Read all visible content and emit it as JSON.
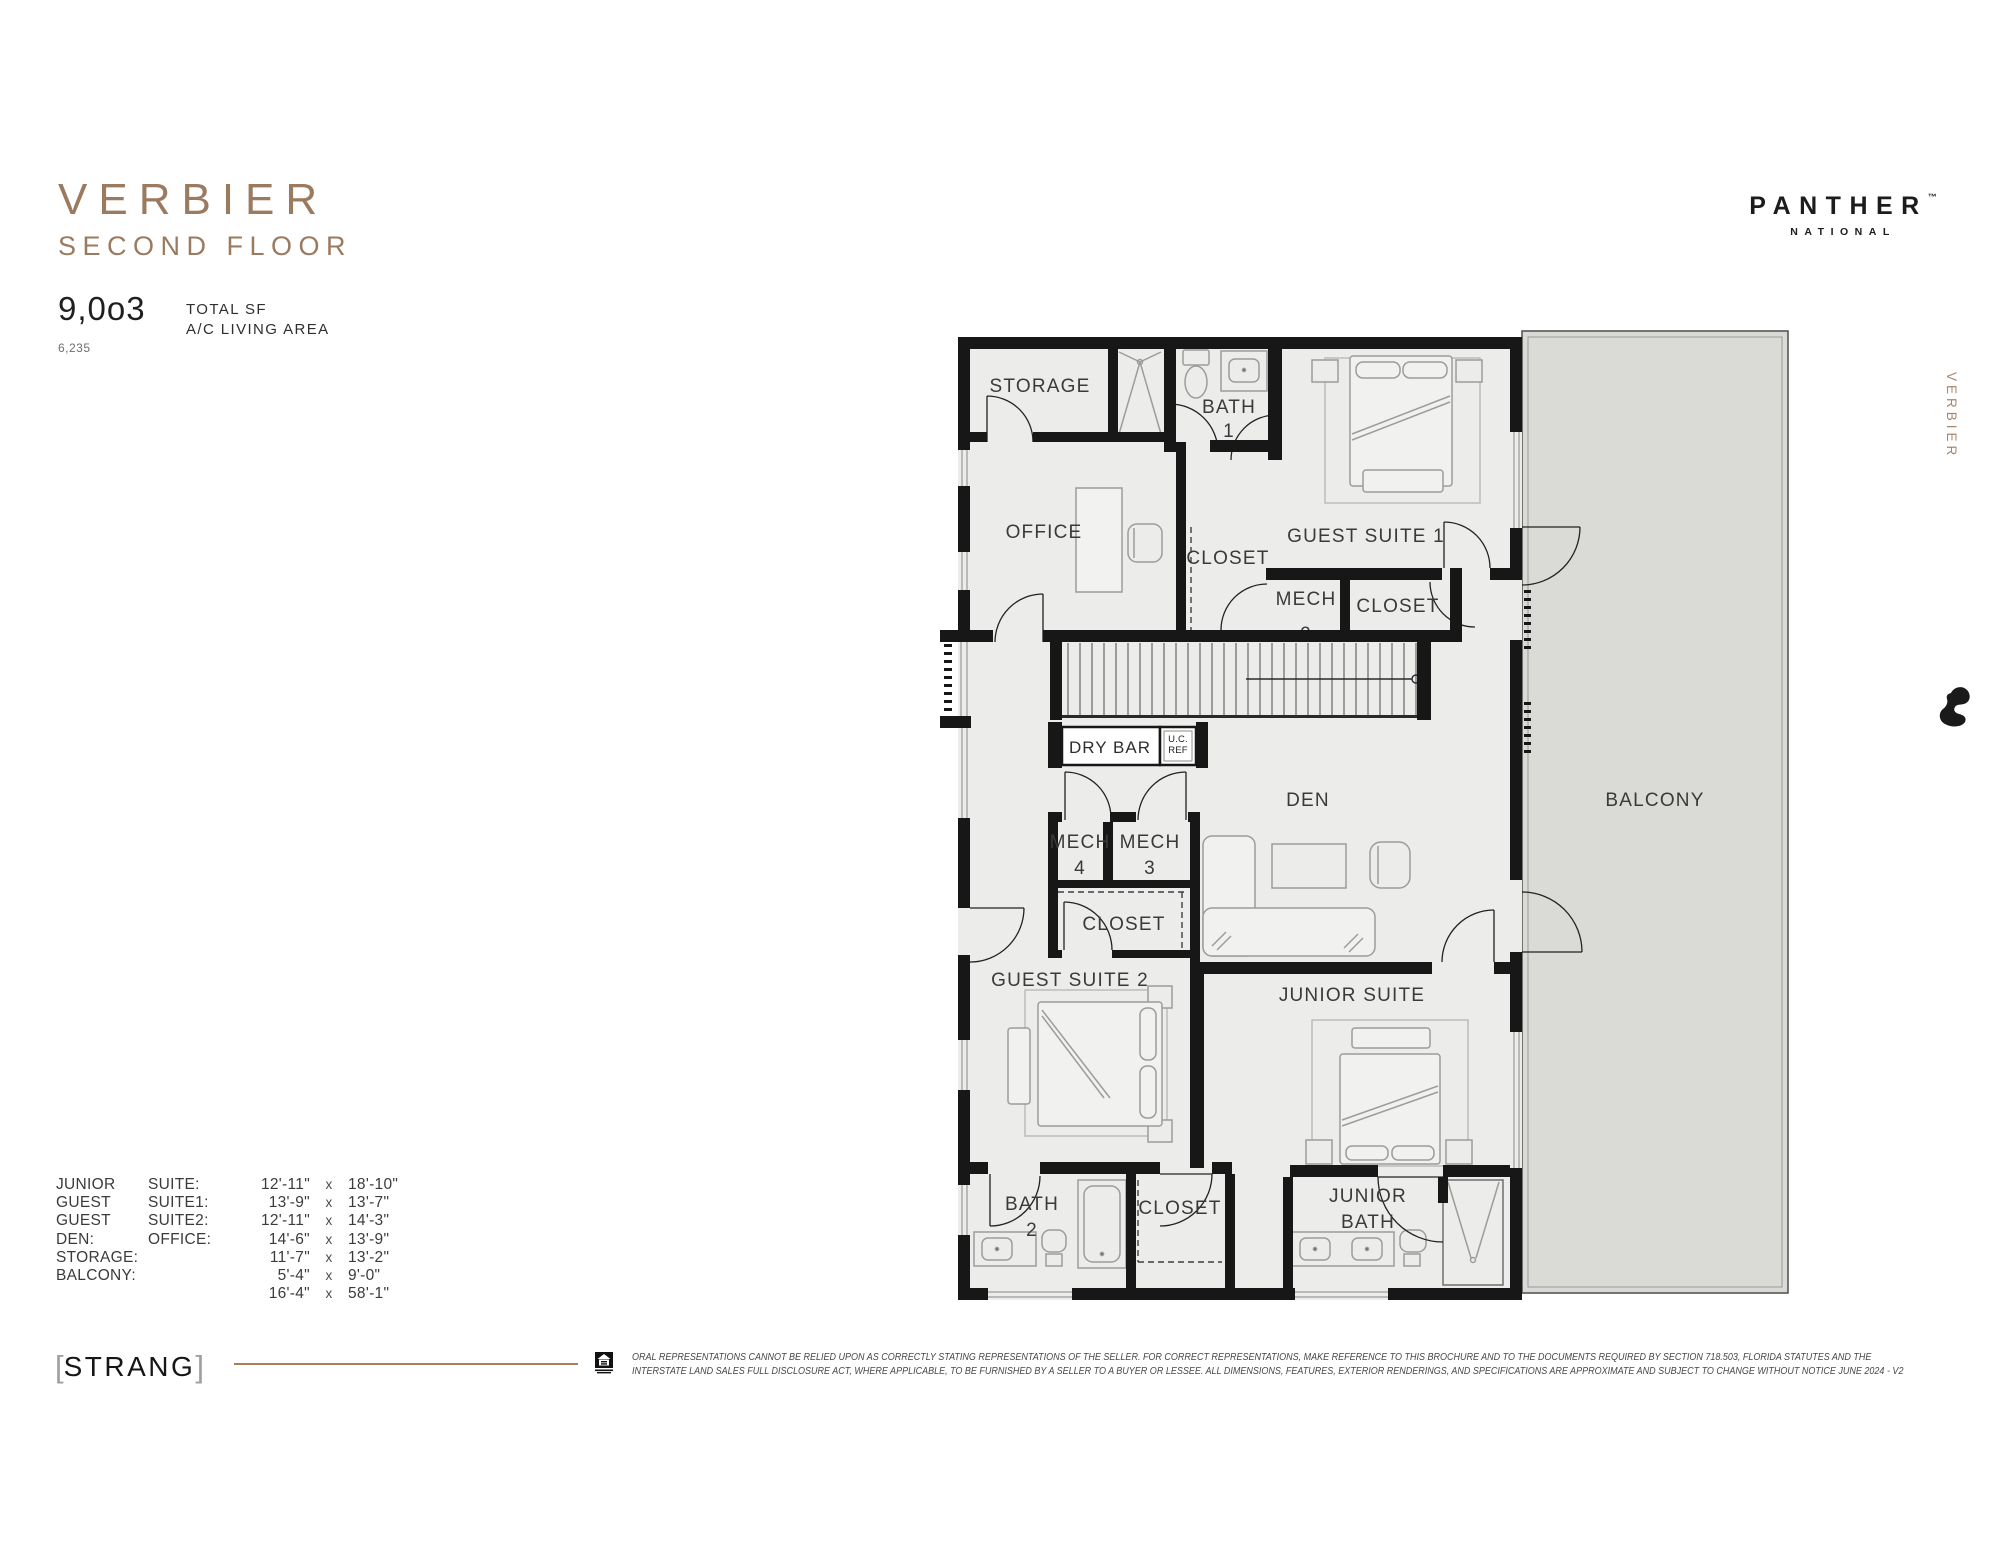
{
  "header": {
    "title": "VERBIER",
    "subtitle": "SECOND FLOOR",
    "total_sf_value": "9,0o3",
    "ac_living_value": "6,235",
    "stat_label_line1": "TOTAL SF",
    "stat_label_line2": "A/C LIVING AREA"
  },
  "brand": {
    "name": "PANTHER",
    "tm": "™",
    "sub": "NATIONAL"
  },
  "side": {
    "vertical_label": "VERBIER"
  },
  "plan": {
    "rooms": {
      "storage": "STORAGE",
      "bath1_l1": "BATH",
      "bath1_l2": "1",
      "guest_suite_1": "GUEST SUITE 1",
      "office": "OFFICE",
      "closet_office": "CLOSET",
      "mech2_l1": "MECH",
      "mech2_l2": "2",
      "closet_gs1": "CLOSET",
      "dry_bar": "DRY BAR",
      "ucref_l1": "U.C.",
      "ucref_l2": "REF",
      "den": "DEN",
      "mech4_l1": "MECH",
      "mech4_l2": "4",
      "mech3_l1": "MECH",
      "mech3_l2": "3",
      "closet_gs2": "CLOSET",
      "guest_suite_2": "GUEST SUITE 2",
      "junior_suite": "JUNIOR SUITE",
      "bath2_l1": "BATH",
      "bath2_l2": "2",
      "closet_bottom": "CLOSET",
      "junior_bath_l1": "JUNIOR",
      "junior_bath_l2": "BATH",
      "balcony": "BALCONY"
    }
  },
  "dimensions": {
    "rows": [
      {
        "a": "JUNIOR",
        "b": "SUITE:",
        "v1": "12'-11\"",
        "x": "x",
        "v2": "18'-10\""
      },
      {
        "a": "GUEST",
        "b": "SUITE1:",
        "v1": "13'-9\"",
        "x": "x",
        "v2": "13'-7\""
      },
      {
        "a": "GUEST",
        "b": "SUITE2:",
        "v1": "12'-11\"",
        "x": "x",
        "v2": "14'-3\""
      },
      {
        "a": "DEN:",
        "b": "OFFICE:",
        "v1": "14'-6\"",
        "x": "x",
        "v2": "13'-9\""
      },
      {
        "a": "STORAGE:",
        "b": "",
        "v1": "11'-7\"",
        "x": "x",
        "v2": "13'-2\""
      },
      {
        "a": "BALCONY:",
        "b": "",
        "v1": "5'-4\"",
        "x": "x",
        "v2": "9'-0\""
      },
      {
        "a": "",
        "b": "",
        "v1": "16'-4\"",
        "x": "x",
        "v2": "58'-1\""
      }
    ]
  },
  "footer": {
    "architect": "STRANG",
    "bracket_left": "[",
    "bracket_right": "]",
    "disclaimer_line1": "ORAL REPRESENTATIONS CANNOT BE RELIED UPON AS CORRECTLY STATING REPRESENTATIONS OF THE SELLER.  FOR CORRECT REPRESENTATIONS, MAKE REFERENCE TO THIS BROCHURE AND TO THE DOCUMENTS REQUIRED BY SECTION 718.503, FLORIDA STATUTES AND THE",
    "disclaimer_line2": "INTERSTATE LAND SALES FULL DISCLOSURE ACT, WHERE APPLICABLE, TO BE FURNISHED BY A SELLER TO A BUYER OR LESSEE.  ALL DIMENSIONS, FEATURES, EXTERIOR RENDERINGS, AND SPECIFICATIONS ARE APPROXIMATE AND SUBJECT TO CHANGE WITHOUT NOTICE  JUNE 2024 - V2"
  },
  "colors": {
    "accent_brown": "#9b7b60",
    "wall": "#171717",
    "room_fill": "#ececeb",
    "balcony_fill": "#dadad7"
  }
}
